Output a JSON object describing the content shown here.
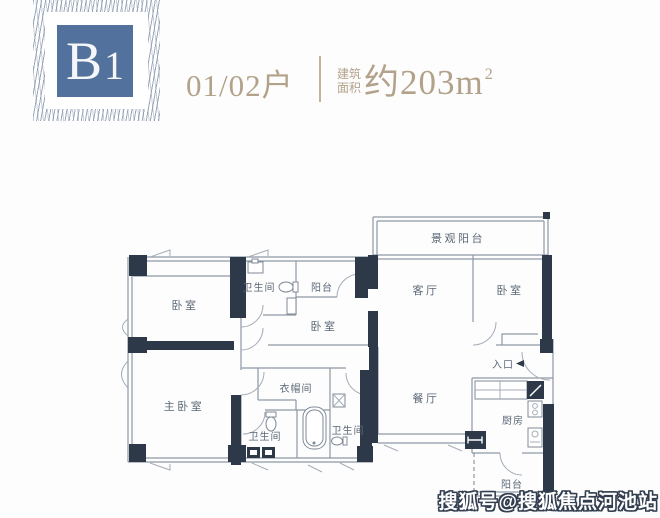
{
  "header": {
    "badge": {
      "letter": "B",
      "digit": "1"
    },
    "unit_label": "01/02户",
    "area_prefix_line1": "建筑",
    "area_prefix_line2": "面积",
    "area_value": "约203m",
    "area_sup": "2"
  },
  "plan": {
    "rooms": [
      {
        "id": "bedroom-nw",
        "label": "卧室"
      },
      {
        "id": "bathroom-top",
        "label": "卫生间"
      },
      {
        "id": "balcony-top",
        "label": "阳台"
      },
      {
        "id": "bedroom-mid",
        "label": "卧室"
      },
      {
        "id": "master-bedroom",
        "label": "主卧室"
      },
      {
        "id": "cloakroom",
        "label": "衣帽间"
      },
      {
        "id": "bathroom-left",
        "label": "卫生间"
      },
      {
        "id": "bathroom-right",
        "label": "卫生间"
      },
      {
        "id": "living-room",
        "label": "客厅"
      },
      {
        "id": "bedroom-east",
        "label": "卧室"
      },
      {
        "id": "scenic-balcony",
        "label": "景观阳台"
      },
      {
        "id": "dining-room",
        "label": "餐厅"
      },
      {
        "id": "entrance",
        "label": "入口"
      },
      {
        "id": "kitchen",
        "label": "厨房"
      },
      {
        "id": "balcony-bottom",
        "label": "阳台"
      }
    ]
  },
  "watermark": "搜狐号@搜狐焦点河池站",
  "colors": {
    "accent_tan": "#b3a28a",
    "badge_blue": "#52719c",
    "wall_dark": "#2d3948",
    "plan_line": "#8e98a4",
    "label_gray": "#5c6877"
  }
}
